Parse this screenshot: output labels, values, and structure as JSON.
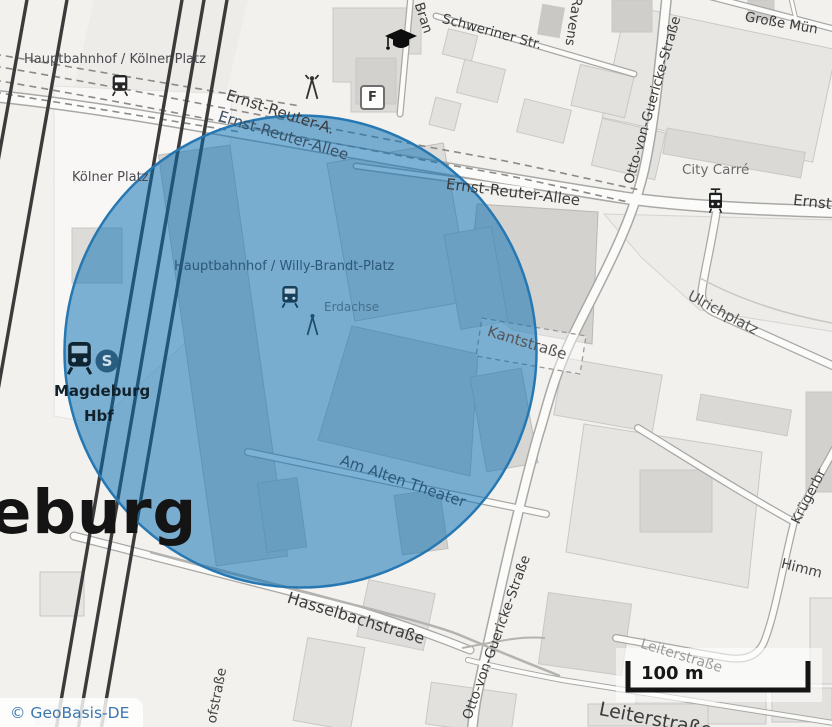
{
  "map": {
    "attribution": "© GeoBasis-DE",
    "scale_bar_label": "100 m",
    "labels": {
      "hbf_koelner": "Hauptbahnhof / Kölner Platz",
      "koelner_platz": "Kölner Platz",
      "ernst_reuter_a": "Ernst-Reuter-A.",
      "ernst_reuter_allee_upper": "Ernst-Reuter-Allee",
      "ernst_reuter_allee_main": "Ernst-Reuter-Allee",
      "ernst_reuter_allee_right": "Ernst-Reuter-Allee",
      "schweriner_str": "Schweriner Str.",
      "bran": "Bran",
      "ravens": "Ravens",
      "grosse_muenz": "Große Mün",
      "otto_von_guericke_top": "Otto-von-Guericke-Straße",
      "otto_von_guericke_bottom": "Otto-von-Guericke-Straße",
      "city_carre": "City Carré",
      "ulrichplatz": "Ulrichplatz",
      "kantstrasse": "Kantstraße",
      "hbf_willy_brandt": "Hauptbahnhof / Willy-Brandt-Platz",
      "erdachse": "Erdachse",
      "magdeburg": "Magdeburg",
      "magdeburg_hbf": "Hbf",
      "am_alten_theater": "Am Alten Theater",
      "hasselbachstrasse": "Hasselbachstraße",
      "leiterstrasse_minor": "Leiterstraße",
      "leiterstrasse_major": "Leiterstraße",
      "himm": "Himm",
      "kruegerbruecke": "Krügerbr",
      "ofstrasse": "ofstraße",
      "city_name_partial": "eburg"
    }
  },
  "icons": {
    "s_bahn_glyph": "S",
    "facility_f_glyph": "F"
  },
  "colors": {
    "circle_fill": "rgba(8,112,180,0.52)",
    "circle_stroke": "#2778b2",
    "attribution_blue": "#3b77af"
  }
}
